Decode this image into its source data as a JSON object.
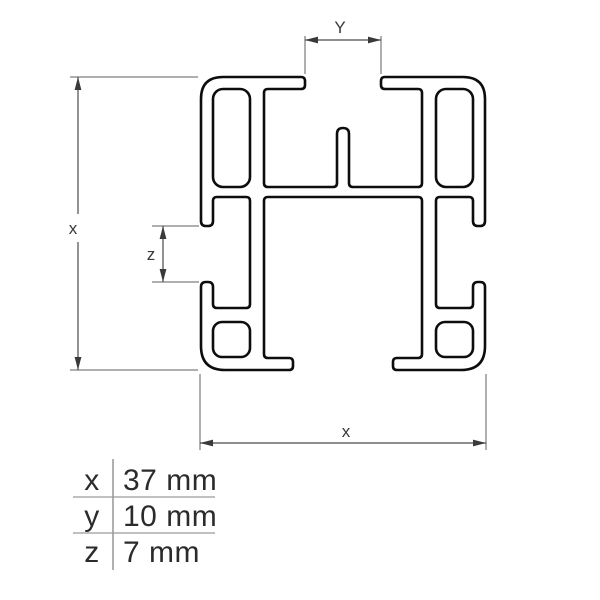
{
  "diagram": {
    "kind": "aluminium-profile-cross-section",
    "dimension_callouts": {
      "top": {
        "label": "Y"
      },
      "left": {
        "label": "x"
      },
      "side": {
        "label": "z"
      },
      "bottom": {
        "label": "x"
      }
    }
  },
  "legend_table": {
    "rows": [
      {
        "symbol": "x",
        "value": "37 mm"
      },
      {
        "symbol": "y",
        "value": "10 mm"
      },
      {
        "symbol": "z",
        "value": "7 mm"
      }
    ]
  },
  "colors": {
    "background": "#ffffff",
    "profile_line": "#0d0d0d",
    "dimension_line": "#4a4a4a",
    "extension_line": "#5f5f5f",
    "table_line": "#9b9b9b",
    "text": "#2b2b2b"
  }
}
